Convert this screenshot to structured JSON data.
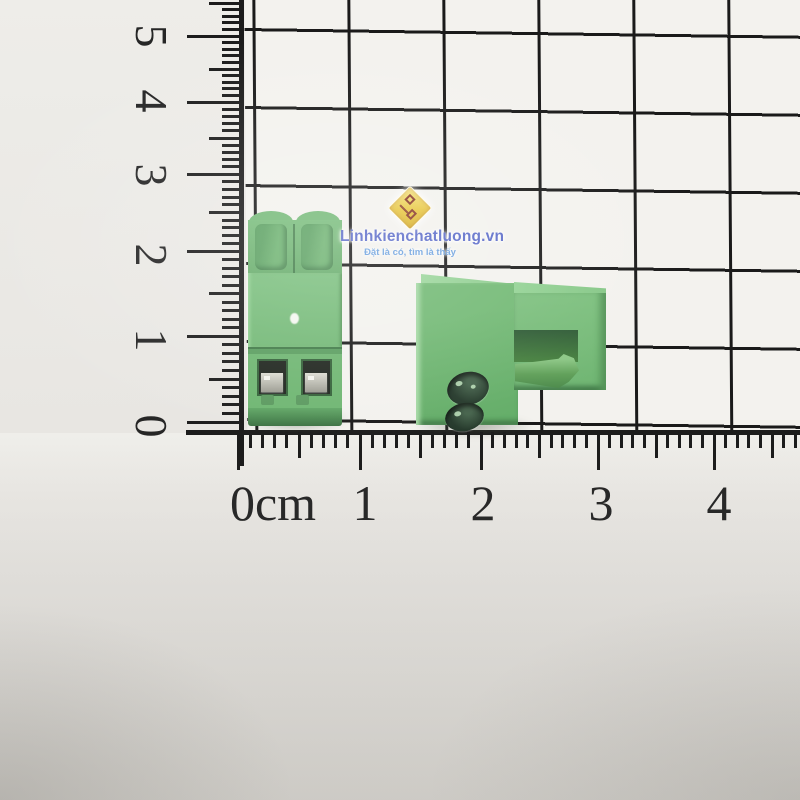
{
  "photo": {
    "subject": "two-green-terminal-blocks-on-cm-grid",
    "background_color": "#e9e7e3",
    "grid_paper_color": "#f3f2ee",
    "grid_line_color": "#1a1a1a"
  },
  "watermark": {
    "brand": "Linhkienchatluong.vn",
    "tagline": "Đặt là có, tìm là thấy",
    "brand_color": "#5c6cc9",
    "tagline_color": "#6fa3e0",
    "logo_icon": "gold-circuit-diamond-icon",
    "logo_color": "#e8c743",
    "logo_trace_color": "#8a3a2a"
  },
  "ruler": {
    "ink_color": "#1c1c1c",
    "horizontal": {
      "labels": [
        "0cm",
        "1",
        "2",
        "3",
        "4"
      ],
      "label_centers_x": [
        273,
        365,
        483,
        601,
        719
      ],
      "major_ticks_x": [
        238,
        360,
        481,
        598,
        714
      ],
      "line_y": 430
    },
    "vertical": {
      "labels": [
        "5",
        "4",
        "3",
        "2",
        "1",
        "0"
      ],
      "label_centers_y": [
        36,
        101,
        175,
        255,
        340,
        426
      ],
      "major_ticks_y": [
        36,
        102,
        174,
        251,
        336,
        422
      ],
      "line_x": 239
    }
  },
  "components": {
    "left_block": {
      "name": "2-pin screw terminal block, front view",
      "pins": 2,
      "body_color": "#6fb672",
      "cap_color": "#68ad6c",
      "window_color": "#20261f",
      "contact_metal_color": "#b9b9af"
    },
    "right_block": {
      "name": "2-pin pluggable terminal block, side view",
      "pins": 2,
      "body_color": "#72b974",
      "top_color": "#93d294",
      "recess_color": "#3c7040",
      "hole_color": "#263a2c",
      "latch_color": "#5f9f58"
    }
  }
}
